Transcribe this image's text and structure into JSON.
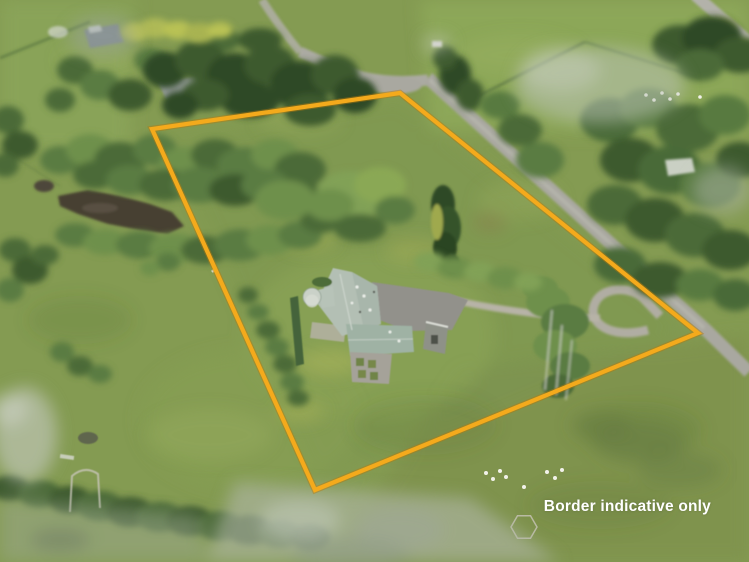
{
  "overlay": {
    "caption": "Border indicative only",
    "caption_color": "#ffffff"
  },
  "boundary": {
    "points": "400,93 152,129 315,490 698,333",
    "line_color": "#F4AA1C",
    "edge_color": "#B97A0A",
    "line_width": "4.2",
    "style": "solid"
  },
  "palette": {
    "grass_base": "#849B52",
    "grass_light": "#93AF5F",
    "grass_olive": "#7E914E",
    "trees_dark": "#2E4A25",
    "trees_mid": "#4C6B38",
    "willow_light": "#6E904C",
    "water": "#473F33",
    "road": "#A9A8A0",
    "gravel": "#BAB5A9",
    "house_roof": "#B3BFB4",
    "turret_roof": "#CAD1C8",
    "sheep": "#F2F2EA"
  }
}
